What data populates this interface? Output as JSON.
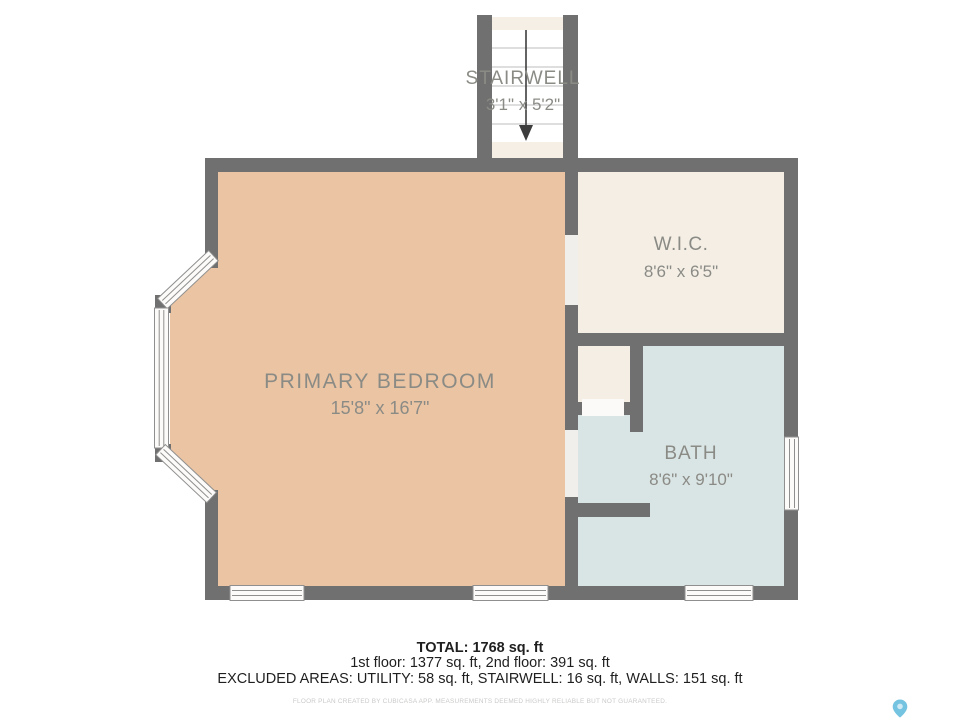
{
  "floorplan": {
    "colors": {
      "wall": "#707070",
      "bedroom_floor": "#eac4a3",
      "wic_floor": "#f4eee5",
      "alcove_floor": "#f4eee5",
      "bath_floor": "#d9e4e4",
      "stair_interior": "#ffffff",
      "stair_landing": "#f5efe6",
      "stair_tread_line": "#bdbdbd",
      "door_opening": "#f1efeb",
      "window_fill": "#fcfbf9",
      "window_stroke": "#8f8f8f",
      "label_text": "#8b8b86",
      "arrow": "#3d3d3d"
    },
    "rooms": {
      "stairwell": {
        "label": "STAIRWELL",
        "dims": "3'1\" x 5'2\""
      },
      "wic": {
        "label": "W.I.C.",
        "dims": "8'6\" x 6'5\""
      },
      "primary_bedroom": {
        "label": "PRIMARY BEDROOM",
        "dims": "15'8\" x 16'7\""
      },
      "bath": {
        "label": "BATH",
        "dims": "8'6\" x 9'10\""
      }
    }
  },
  "summary": {
    "total": "TOTAL: 1768 sq. ft",
    "floors": "1st floor: 1377 sq. ft, 2nd floor: 391 sq. ft",
    "excluded": "EXCLUDED AREAS: UTILITY: 58 sq. ft, STAIRWELL: 16 sq. ft, WALLS: 151 sq. ft",
    "disclaimer": "FLOOR PLAN CREATED BY CUBICASA APP. MEASUREMENTS DEEMED HIGHLY RELIABLE BUT NOT GUARANTEED."
  },
  "branding": {
    "pin_color": "#74c3e0",
    "pin_inner_color": "#cfeaf5"
  }
}
